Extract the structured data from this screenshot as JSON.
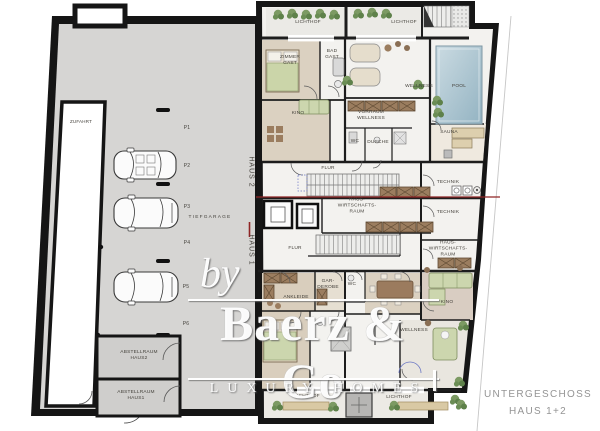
{
  "plan": {
    "caption": {
      "line1": "UNTERGESCHOSS",
      "line2": "HAUS 1+2"
    },
    "watermark": {
      "by": "by",
      "brand": "Baerz & Co",
      "tagline": "LUXURY HOMES"
    },
    "colors": {
      "wall": "#161616",
      "garage_floor": "#d6d5d3",
      "carpet_beige": "#dbd1c1",
      "pool_water": "#a9c3cf",
      "plant_green": "#6d8f58",
      "divider_red": "#8f2424",
      "caption_gray": "#949494",
      "watermark_white": "#ffffff"
    },
    "labels": [
      {
        "id": "lichthof-top-left",
        "text": "LICHTHOF",
        "x": 308,
        "y": 23
      },
      {
        "id": "lichthof-top-right",
        "text": "LICHTHOF",
        "x": 404,
        "y": 23
      },
      {
        "id": "zimmer-gast",
        "text": "ZIMMER\nGAST",
        "x": 290,
        "y": 61
      },
      {
        "id": "bad-gast",
        "text": "BAD\nGAST",
        "x": 332,
        "y": 55
      },
      {
        "id": "kino-haus2",
        "text": "KINO",
        "x": 298,
        "y": 114
      },
      {
        "id": "wellness-haus2",
        "text": "WELLNESS",
        "x": 419,
        "y": 87
      },
      {
        "id": "pool",
        "text": "POOL",
        "x": 459,
        "y": 87
      },
      {
        "id": "vorraum-wellness",
        "text": "VORRAUM\nWELLNESS",
        "x": 371,
        "y": 116
      },
      {
        "id": "wc-haus2",
        "text": "WC",
        "x": 355,
        "y": 142
      },
      {
        "id": "dusche",
        "text": "DUSCHE",
        "x": 378,
        "y": 143
      },
      {
        "id": "sauna",
        "text": "SAUNA",
        "x": 449,
        "y": 133
      },
      {
        "id": "flur-haus2",
        "text": "FLUR",
        "x": 328,
        "y": 169
      },
      {
        "id": "technik-1",
        "text": "TECHNIK",
        "x": 448,
        "y": 183
      },
      {
        "id": "technik-2",
        "text": "TECHNIK",
        "x": 448,
        "y": 213
      },
      {
        "id": "hauswirtschaftsraum-mitte",
        "text": "HAUS-\nWIRTSCHAFTS-\nRAUM",
        "x": 357,
        "y": 207
      },
      {
        "id": "hauswirtschaftsraum-rechts",
        "text": "HAUS-\nWIRTSCHAFTS-\nRAUM",
        "x": 448,
        "y": 250
      },
      {
        "id": "flur-haus1",
        "text": "FLUR",
        "x": 295,
        "y": 249
      },
      {
        "id": "ankleide",
        "text": "ANKLEIDE",
        "x": 296,
        "y": 298
      },
      {
        "id": "garderobe",
        "text": "GAR-\nDEROBE",
        "x": 328,
        "y": 285
      },
      {
        "id": "wc-haus1",
        "text": "WC",
        "x": 352,
        "y": 285
      },
      {
        "id": "kino-haus1",
        "text": "KINO",
        "x": 447,
        "y": 303
      },
      {
        "id": "wellness-haus1",
        "text": "WELLNESS",
        "x": 414,
        "y": 331
      },
      {
        "id": "lichthof-bottom-left",
        "text": "LICHTHOF",
        "x": 307,
        "y": 397
      },
      {
        "id": "lichthof-bottom-right",
        "text": "LICHTHOF",
        "x": 399,
        "y": 398
      },
      {
        "id": "zufahrt",
        "text": "ZUFAHRT",
        "x": 81,
        "y": 122,
        "size": 4.5
      },
      {
        "id": "tiefgarage",
        "text": "TIEFGARAGE",
        "x": 210,
        "y": 218,
        "ls": 1.2
      },
      {
        "id": "p1",
        "text": "P1",
        "x": 187,
        "y": 128,
        "size": 5
      },
      {
        "id": "p2",
        "text": "P2",
        "x": 187,
        "y": 166,
        "size": 5
      },
      {
        "id": "p3",
        "text": "P3",
        "x": 187,
        "y": 207,
        "size": 5
      },
      {
        "id": "p4",
        "text": "P4",
        "x": 187,
        "y": 243,
        "size": 5
      },
      {
        "id": "p5",
        "text": "P5",
        "x": 186,
        "y": 287,
        "size": 5
      },
      {
        "id": "p6",
        "text": "P6",
        "x": 186,
        "y": 324,
        "size": 5
      },
      {
        "id": "abstellraum-haus2",
        "text": "ABSTELLRAUM\nHAUS2",
        "x": 139,
        "y": 356
      },
      {
        "id": "abstellraum-haus1",
        "text": "ABSTELLRAUM\nHAUS1",
        "x": 136,
        "y": 396
      },
      {
        "id": "haus-2",
        "text": "HAUS 2",
        "x": 251,
        "y": 172,
        "rot": 90,
        "size": 7,
        "ls": 1
      },
      {
        "id": "haus-1",
        "text": "HAUS 1",
        "x": 251,
        "y": 250,
        "rot": 90,
        "size": 7,
        "ls": 1
      }
    ]
  }
}
